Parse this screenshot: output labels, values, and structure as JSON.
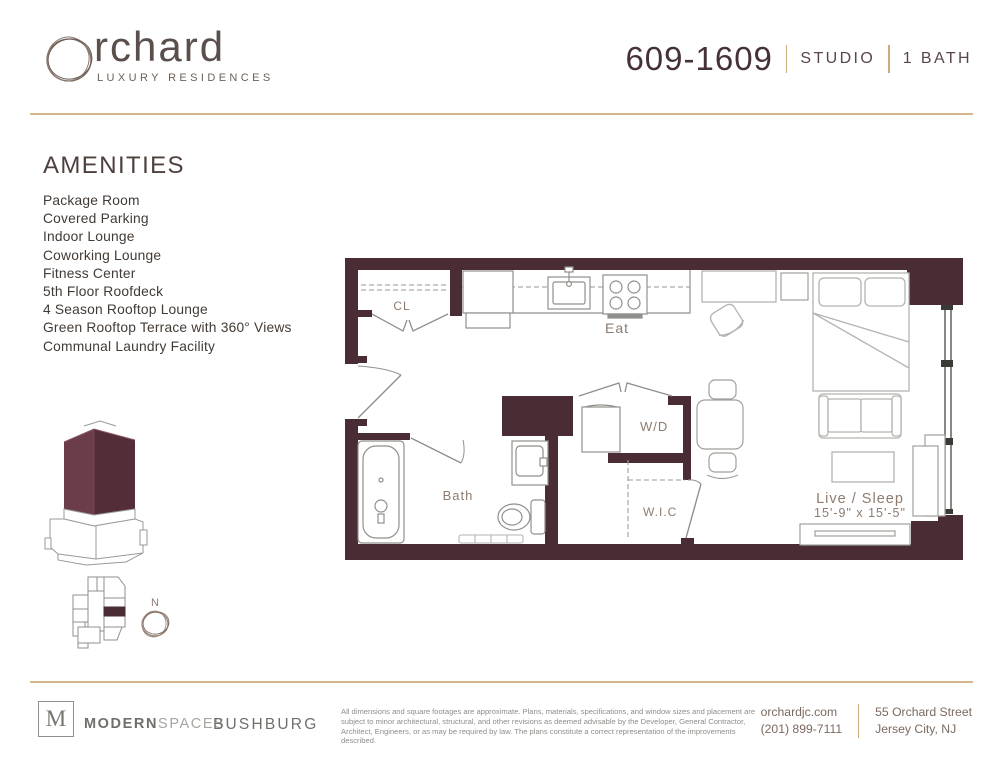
{
  "header": {
    "brand": {
      "name": "rchard",
      "tagline": "LUXURY RESIDENCES"
    },
    "unit": {
      "number": "609-1609",
      "type": "STUDIO",
      "baths": "1 BATH"
    }
  },
  "amenities": {
    "title": "AMENITIES",
    "items": [
      "Package Room",
      "Covered Parking",
      "Indoor Lounge",
      "Coworking Lounge",
      "Fitness Center",
      "5th Floor Roofdeck",
      "4 Season Rooftop Lounge",
      "Green Rooftop Terrace with 360° Views",
      "Communal Laundry Facility"
    ]
  },
  "floorplan": {
    "labels": {
      "closet": "CL",
      "kitchen": "Eat",
      "bath": "Bath",
      "washer_dryer": "W/D",
      "walk_in_closet": "W.I.C",
      "living": "Live / Sleep",
      "living_dims": "15'-9\" x 15'-5\""
    }
  },
  "keyplan": {
    "north_label": "N"
  },
  "footer": {
    "modern_spaces": {
      "logo_letter": "M",
      "name_bold": "MODERN",
      "name_light": "SPACES"
    },
    "bushburg": "BUSHBURG",
    "disclaimer": "All dimensions and square footages are approximate. Plans, materials, specifications, and window sizes and placement are subject to minor architectural, structural, and other revisions as deemed advisable by the Developer, General Contractor, Architect, Engineers, or as may be required by law. The plans constitute a correct representation of the improvements described.",
    "contact": {
      "website": "orchardjc.com",
      "phone": "(201) 899-7111",
      "address_line1": "55 Orchard Street",
      "address_line2": "Jersey City, NJ"
    }
  },
  "colors": {
    "wall": "#4a2d34",
    "accent_tan": "#d3b68c",
    "text_dark": "#453236",
    "plan_label": "#8d7b70"
  }
}
